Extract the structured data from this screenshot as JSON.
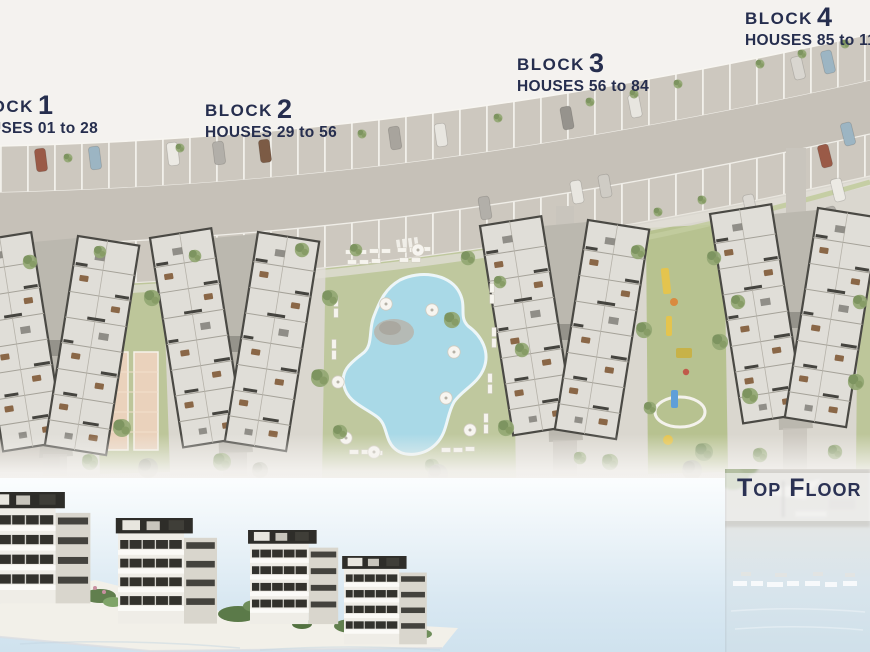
{
  "page": {
    "background_color": "#f4f2ef",
    "text_color": "#262e4e"
  },
  "site_plan": {
    "blocks": [
      {
        "label": "BLOCK",
        "number": "1",
        "houses_range": "HOUSES 01 to 28"
      },
      {
        "label": "BLOCK",
        "number": "2",
        "houses_range": "HOUSES 29 to 56"
      },
      {
        "label": "BLOCK",
        "number": "3",
        "houses_range": "HOUSES 56 to 84"
      },
      {
        "label": "BLOCK",
        "number": "4",
        "houses_range": "HOUSES 85 to 11"
      }
    ],
    "colors": {
      "road": "#c6c1b8",
      "parking_stalls": "#cdc8bf",
      "ground": "#dad7cf",
      "lawn": "#bec79c",
      "pool_water": "#a9d9e7",
      "building_fill": "#e0ded8",
      "building_outline": "#4a4944",
      "court_tan": "#ead2bc"
    }
  },
  "bottom_band": {
    "top_floor_label": "Top Floor",
    "sky_top": "#fbfdfe",
    "sky_bottom": "#cfe2ee"
  }
}
